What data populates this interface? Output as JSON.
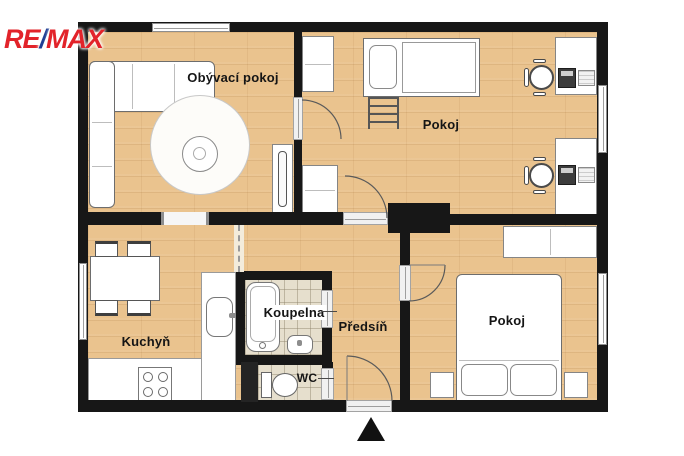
{
  "logo": {
    "re": "RE",
    "slash": "/",
    "max": "MAX",
    "color_red": "#e2232a",
    "color_blue": "#1e3d94"
  },
  "plan": {
    "type": "apartment-floor-plan",
    "colors": {
      "wall": "#171717",
      "floor_wood": "#eac38e",
      "floor_tile": "#e6dfcd",
      "furniture_fill": "#ffffff",
      "furniture_outline": "#6d6d6d"
    },
    "entrance_marker": "entrance-arrow",
    "rooms": {
      "living": {
        "label": "Obývací pokoj",
        "furniture": [
          "corner-sofa",
          "round-rug",
          "coffee-table",
          "tv-cabinet",
          "window"
        ]
      },
      "kids_room": {
        "label": "Pokoj",
        "furniture": [
          "wardrobe",
          "wardrobe",
          "loft-bed",
          "ladder",
          "desk",
          "desk",
          "office-chair",
          "office-chair",
          "computer",
          "computer",
          "window"
        ]
      },
      "kitchen": {
        "label": "Kuchyň",
        "furniture": [
          "dining-table",
          "chair",
          "chair",
          "chair",
          "chair",
          "counter",
          "sink",
          "stove",
          "window"
        ]
      },
      "bathroom": {
        "label": "Koupelna",
        "furniture": [
          "bathtub",
          "washbasin"
        ]
      },
      "wc": {
        "label": "WC",
        "furniture": [
          "toilet"
        ]
      },
      "hall": {
        "label": "Předsíň",
        "furniture": []
      },
      "bedroom": {
        "label": "Pokoj",
        "furniture": [
          "double-bed",
          "pillow",
          "pillow",
          "wardrobe",
          "nightstand",
          "nightstand",
          "window"
        ]
      }
    }
  }
}
